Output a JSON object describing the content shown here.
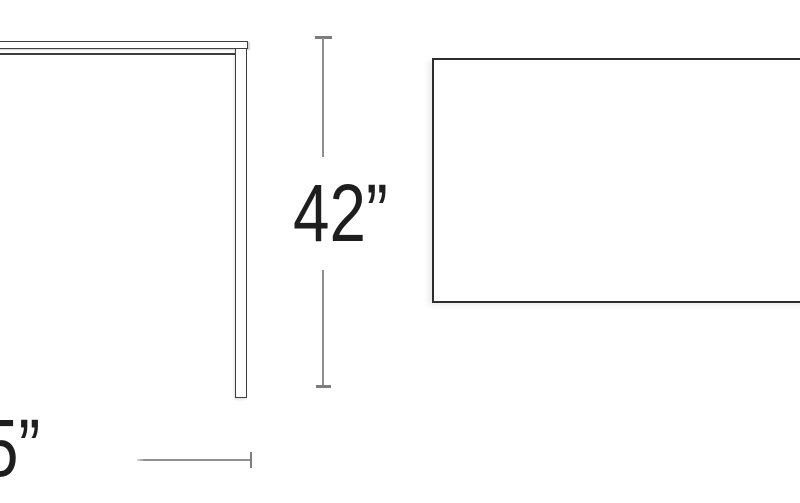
{
  "diagram": {
    "background_color": "#ffffff",
    "side_view_outline_color": "#3f3f3f",
    "top_view_outline_color": "#2d2d2d",
    "dimension_line_color": "#8f8f8f",
    "dimension_tick_color": "#7d7d7d",
    "label_color": "#1e1e1e",
    "dimensions": {
      "height": {
        "label": "42”"
      },
      "width": {
        "label": "5”"
      }
    }
  }
}
